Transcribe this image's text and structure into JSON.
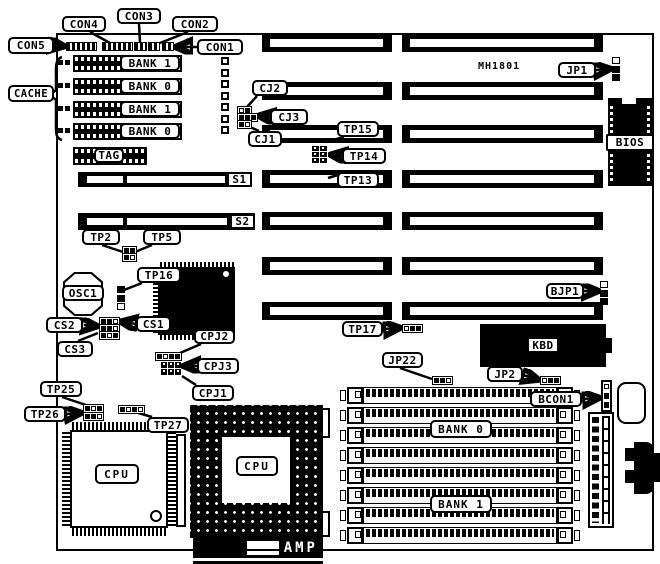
{
  "diagram": {
    "type": "motherboard-layout",
    "colors": {
      "foreground": "#000000",
      "background": "#ffffff"
    },
    "chipset_marking": "MH1801",
    "connectors": {
      "con1": "CON1",
      "con2": "CON2",
      "con3": "CON3",
      "con4": "CON4",
      "con5": "CON5",
      "bcon1": "BCON1",
      "kbd": "KBD",
      "amp": "AMP"
    },
    "cache": {
      "label": "CACHE",
      "rows": [
        "BANK 1",
        "BANK 0",
        "BANK 1",
        "BANK 0"
      ],
      "tag": "TAG"
    },
    "slots": {
      "s1": "S1",
      "s2": "S2"
    },
    "jumpers": {
      "jp1": "JP1",
      "jp2": "JP2",
      "jp22": "JP22",
      "bjp1": "BJP1",
      "cj1": "CJ1",
      "cj2": "CJ2",
      "cj3": "CJ3",
      "cpj1": "CPJ1",
      "cpj2": "CPJ2",
      "cpj3": "CPJ3"
    },
    "test_points": {
      "tp2": "TP2",
      "tp5": "TP5",
      "tp13": "TP13",
      "tp14": "TP14",
      "tp15": "TP15",
      "tp16": "TP16",
      "tp17": "TP17",
      "tp25": "TP25",
      "tp26": "TP26",
      "tp27": "TP27"
    },
    "chip_selects": {
      "cs1": "CS1",
      "cs2": "CS2",
      "cs3": "CS3"
    },
    "components": {
      "osc1": "OSC1",
      "bios": "BIOS",
      "cpu_qfp": "CPU",
      "cpu_pga": "CPU"
    },
    "memory": {
      "bank0": "BANK 0",
      "bank1": "BANK 1"
    }
  }
}
